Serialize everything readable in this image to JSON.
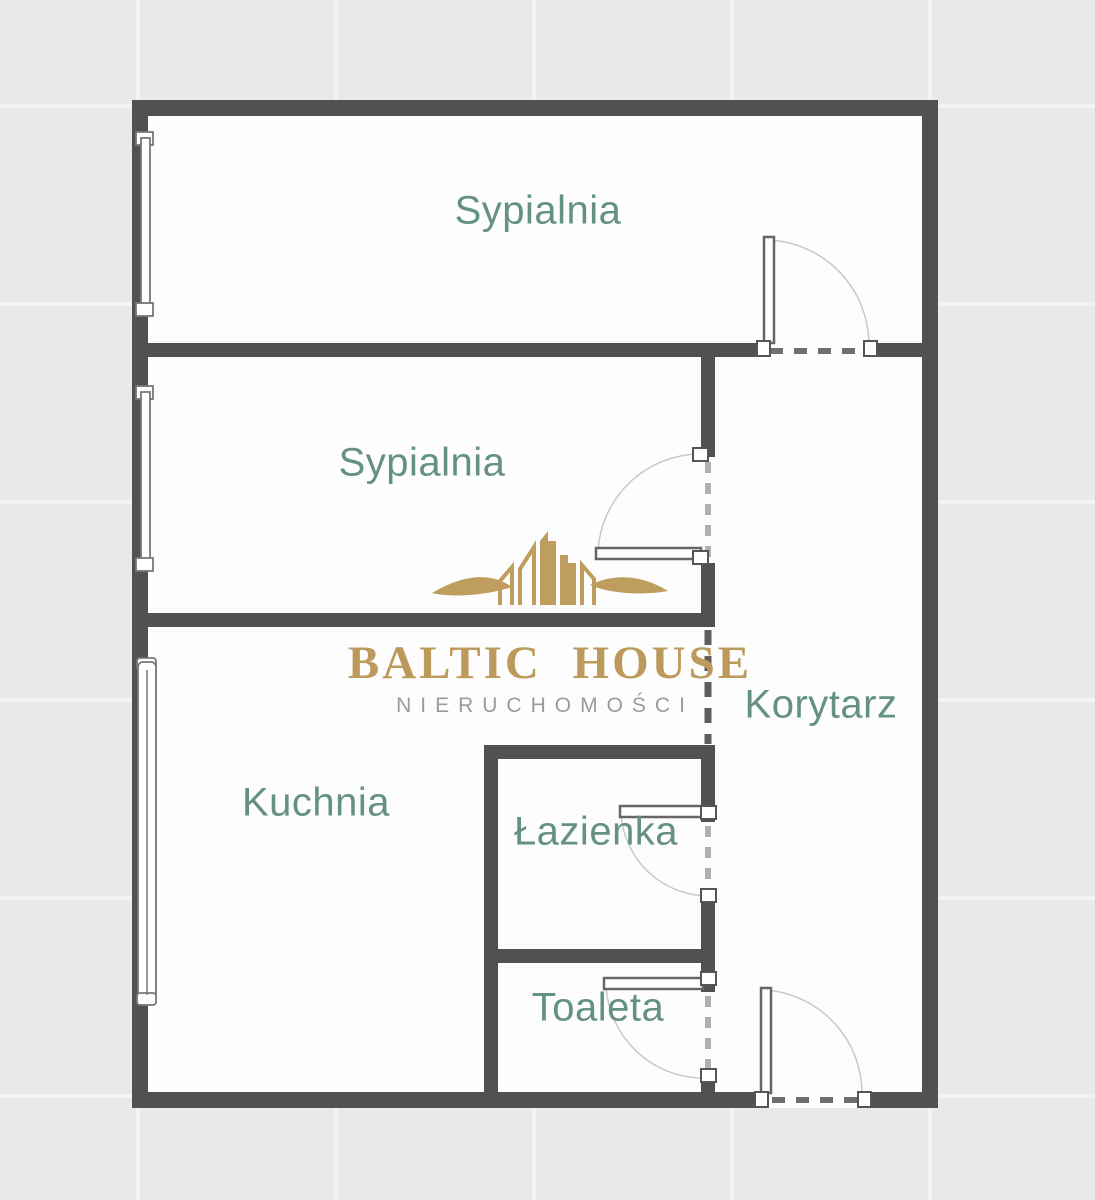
{
  "brand": {
    "wordmark": "BALTIC HOUSE",
    "subtitle": "NIERUCHOMOŚCI"
  },
  "rooms": [
    {
      "id": "sypialnia-1",
      "label": "Sypialnia"
    },
    {
      "id": "sypialnia-2",
      "label": "Sypialnia"
    },
    {
      "id": "korytarz",
      "label": "Korytarz"
    },
    {
      "id": "kuchnia",
      "label": "Kuchnia"
    },
    {
      "id": "lazienka",
      "label": "Łazienka"
    },
    {
      "id": "toaleta",
      "label": "Toaleta"
    }
  ],
  "colors": {
    "background": "#e9e9e9",
    "tile_line": "#f3f3f3",
    "wall": "#515151",
    "room_fill": "#fdfdfd",
    "room_label": "#649086",
    "logo_gold": "#bc9a5b",
    "logo_subtitle_gray": "#9b9b9b"
  }
}
